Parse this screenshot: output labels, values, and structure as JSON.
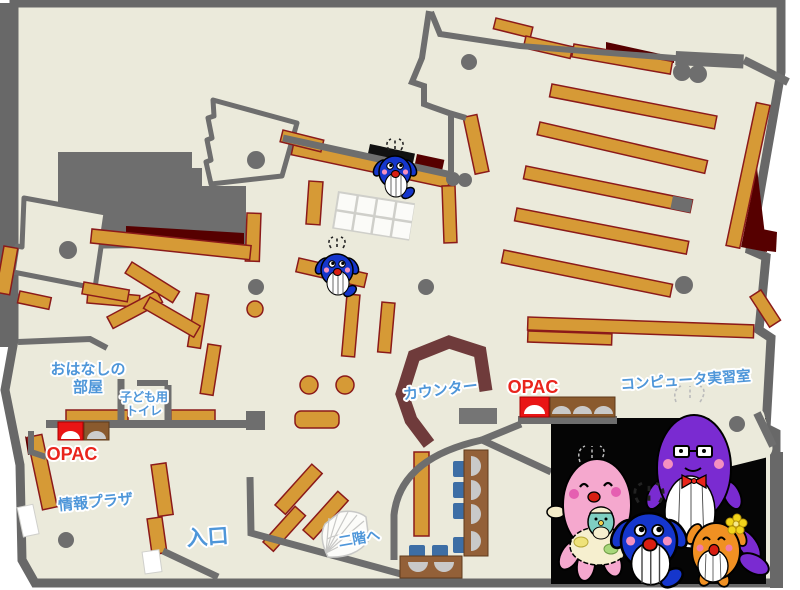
{
  "map": {
    "title_hint": "library-first-floor-map",
    "labels": {
      "storytelling_room": {
        "line1": "おはなしの",
        "line2": "部屋"
      },
      "kids_toilet": {
        "line1": "子ども用",
        "line2": "トイレ"
      },
      "opac_left": "OPAC",
      "info_plaza": "情報プラザ",
      "entrance": "入口",
      "counter": "カウンター",
      "opac_center": "OPAC",
      "computer_room": "コンピュータ実習室",
      "to_second_floor": "二階へ"
    },
    "palette": {
      "floor": "#EBEADB",
      "wall_gray": "#6E6E6E",
      "shelf_orange": "#D69A36",
      "shelf_border": "#8B1A1A",
      "dark_red_carpet": "#560000",
      "counter_maroon": "#6F3B3B",
      "label_blue": "#4E96D9",
      "label_red": "#E9241C",
      "chair_blue": "#3D6EA5",
      "table_brown": "#936038",
      "photo_background": "#000000",
      "whale_blue": "#1536CC",
      "mother_pink": "#F5A8CE",
      "father_purple": "#7A2BD1",
      "child_orange": "#F09022"
    },
    "photo": {
      "characters": [
        "pink-mother-whale-with-baby",
        "blue-child-whale",
        "purple-father-whale-with-glasses",
        "orange-child-whale-with-flower"
      ]
    }
  }
}
